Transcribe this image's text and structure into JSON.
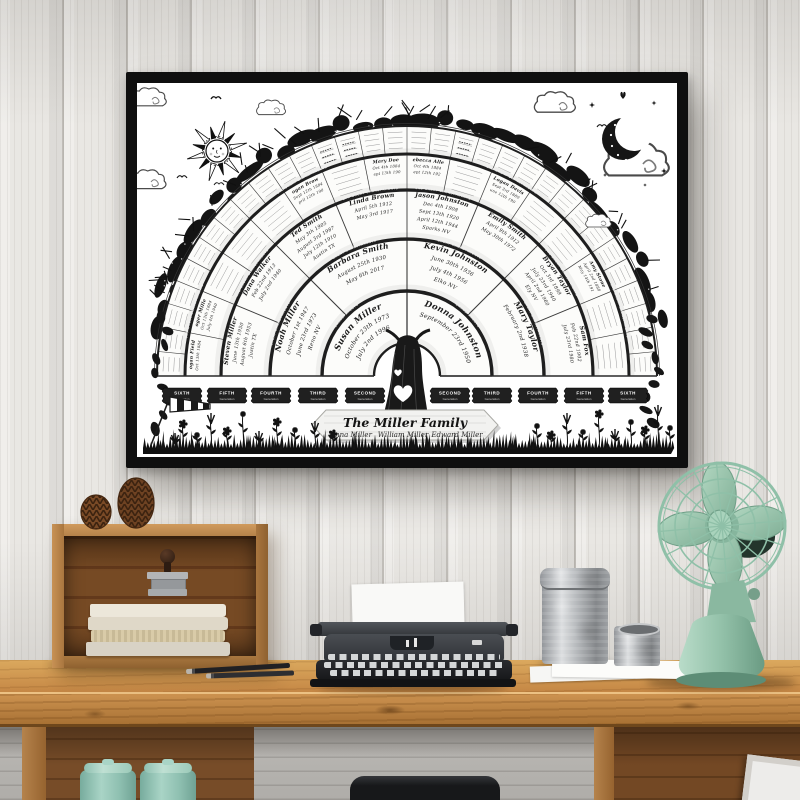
{
  "poster": {
    "title": "The Miller Family",
    "family_members": [
      "Anna Miller",
      "William Miller",
      "Edward Miller"
    ],
    "generation_badges": [
      {
        "line1": "SIXTH",
        "line2": "Generation"
      },
      {
        "line1": "FIFTH",
        "line2": "Generation"
      },
      {
        "line1": "FOURTH",
        "line2": "Generation"
      },
      {
        "line1": "THIRD",
        "line2": "Generation"
      },
      {
        "line1": "SECOND",
        "line2": "Generation"
      },
      {
        "line1": "SECOND",
        "line2": "Generation"
      },
      {
        "line1": "THIRD",
        "line2": "Generation"
      },
      {
        "line1": "FOURTH",
        "line2": "Generation"
      },
      {
        "line1": "FIFTH",
        "line2": "Generation"
      },
      {
        "line1": "SIXTH",
        "line2": "Generation"
      }
    ],
    "ring_band_labels": [
      "GRANDPARENTS",
      "GREAT GRANDPARENTS",
      "2ND GREAT GRANDPARENTS",
      "3RD GREAT GRANDPARENTS"
    ],
    "fan": {
      "gen2": [
        {
          "name": "Susan Miller",
          "details": [
            "October 23th 1973",
            "July 2nd 1996"
          ]
        },
        {
          "name": "Donna Johnston",
          "details": [
            "September 23rd 1950"
          ]
        }
      ],
      "gen3": [
        {
          "name": "Noah Miller",
          "details": [
            "October 1st 1947",
            "June 23rd 1973",
            "Reno NV"
          ]
        },
        {
          "name": "Barbara Smith",
          "details": [
            "August 25th 1930",
            "May 6th 2017"
          ]
        },
        {
          "name": "Kevin Johnston",
          "details": [
            "June 30th 1936",
            "July 4th 1956",
            "Elko NV"
          ]
        },
        {
          "name": "Mary Taylor",
          "details": [
            "February 2nd 1938"
          ]
        }
      ],
      "gen4": [
        {
          "name": "Steven Miller",
          "details": [
            "June 13th 1950",
            "August 6th 1953",
            "Justin TX"
          ]
        },
        {
          "name": "Dana Walker",
          "details": [
            "Feb 22nd 1913",
            "July 2nd 1940"
          ]
        },
        {
          "name": "Ted Smith",
          "details": [
            "May 3th 1905",
            "August 3rd 1987",
            "July 12th 1910",
            "Austin TX"
          ]
        },
        {
          "name": "Linda Brown",
          "details": [
            "April 5th 1912",
            "May 3rd 1917"
          ]
        },
        {
          "name": "Jason Johnston",
          "details": [
            "Dec 4th 1908",
            "Sept 13th 1920",
            "April 12th 1944",
            "Sparks NV"
          ]
        },
        {
          "name": "Emily Smith",
          "details": [
            "April 9th 1912",
            "May 30th 1972"
          ]
        },
        {
          "name": "Bryan Taylor",
          "details": [
            "Oct 3rd 1899",
            "July 23rd 1940",
            "April 2nd 1960",
            "Ely NV"
          ]
        },
        {
          "name": "Sam Fox",
          "details": [
            "Feb 22nd 1902",
            "July 23rd 1980"
          ]
        }
      ],
      "gen5": [
        {
          "name": "Logan Fields",
          "details": [
            "Oct 13th 1884"
          ]
        },
        {
          "name": "Roger Miller",
          "details": [
            "Oct 13th 1884",
            "July 4th 1940"
          ]
        },
        null,
        null,
        null,
        {
          "name": "Logan Brown",
          "details": [
            "Sept 12th 1884",
            "April 12th 1900"
          ]
        },
        null,
        {
          "name": "Mary Doe",
          "details": [
            "Oct 4th 1884",
            "Sept 13th 1905"
          ]
        },
        {
          "name": "Rebecca Allen",
          "details": [
            "Oct 4th 1884",
            "Sept 12th 1920"
          ]
        },
        null,
        {
          "name": "Logan Davis",
          "details": [
            "Sept 3rd 1880",
            "June 12th 1903"
          ]
        },
        null,
        null,
        {
          "name": "Amy Stone",
          "details": [
            "April 2nd 1888",
            "May 14th 1910"
          ]
        },
        null,
        null
      ],
      "gen6_written": [
        12,
        13,
        18
      ]
    },
    "decor": [
      "sun-icon",
      "moon-icon",
      "cloud-icon",
      "bird-icon",
      "butterfly-icon",
      "star-icon",
      "foliage",
      "grass",
      "wildflowers",
      "windsock",
      "tree-trunk",
      "heart-cutout",
      "wood-sign"
    ]
  },
  "scene": {
    "objects": [
      "white wood plank wall",
      "black poster frame",
      "wooden crate shelf",
      "two pinecones",
      "stack of books",
      "rubber stamp",
      "two pencils",
      "vintage typewriter with paper",
      "large galvanized canister",
      "small galvanized canister",
      "paper sheets",
      "mint vintage desk fan",
      "oak desk",
      "mint storage jars",
      "dark stool",
      "leaning picture frame"
    ]
  },
  "colors": {
    "poster_frame": "#0f0f0f",
    "ink": "#1b1b1b",
    "wall": "#e9e7e3",
    "desk_wood": "#c58745",
    "fan_mint": "#9ccab1",
    "jar_mint": "#8fc3b2"
  }
}
